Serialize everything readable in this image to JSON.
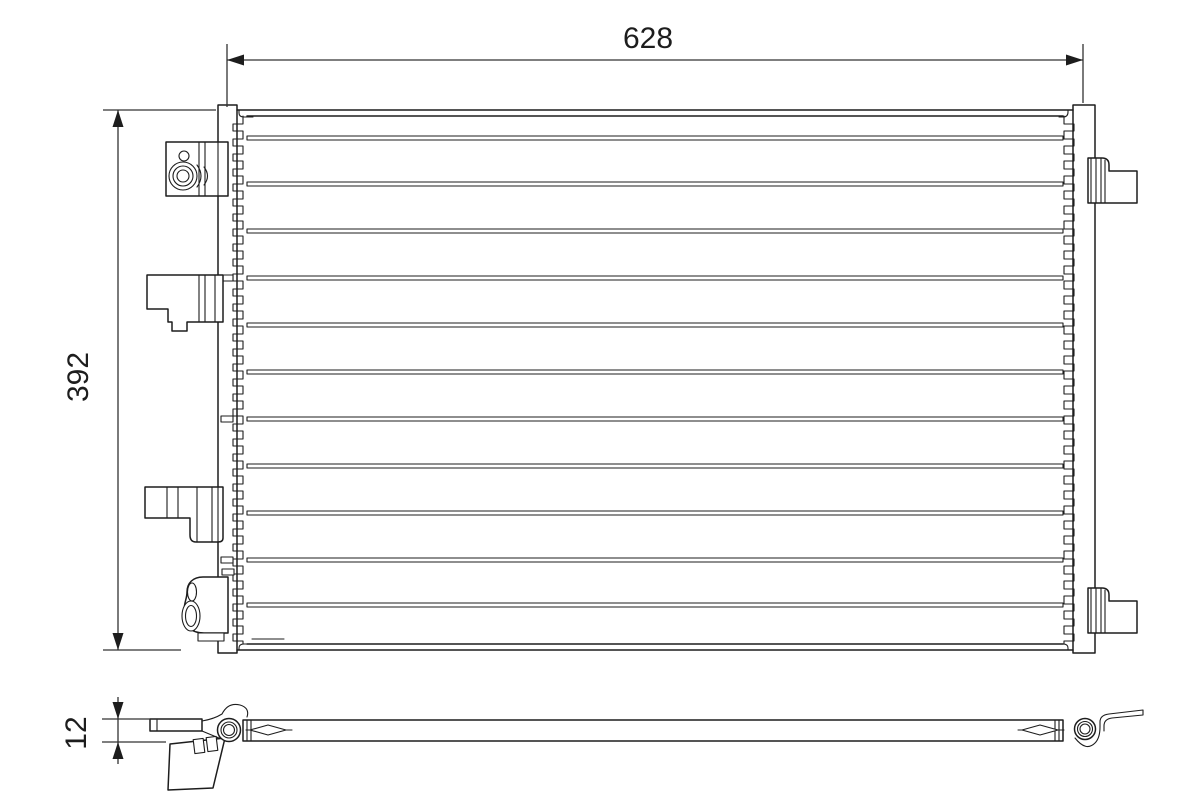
{
  "drawing": {
    "dimensions": {
      "width": "628",
      "height": "392",
      "thickness": "12"
    },
    "colors": {
      "line": "#1d1d1d",
      "dimension_line": "#333333",
      "background": "#ffffff"
    }
  }
}
